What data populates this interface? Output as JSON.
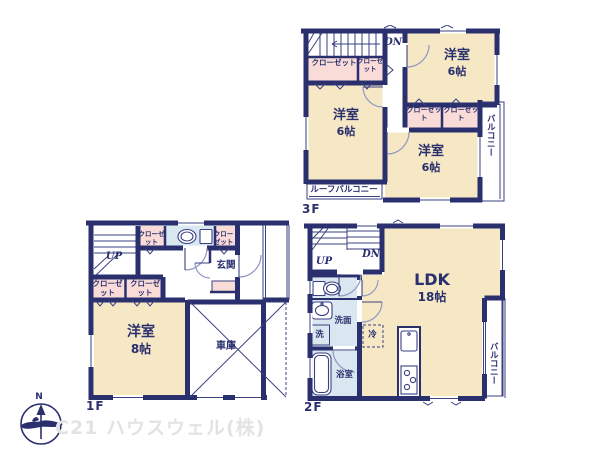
{
  "colors": {
    "wall": "#2A2F6E",
    "line": "#3A4080",
    "arc": "#9298C4",
    "cream": "#F6E8C5",
    "pink": "#F9DCD8",
    "blue": "#D9E7F1",
    "fridge": "#F8E3DF",
    "watermark": "#E3E3E3"
  },
  "f3": {
    "floor_label": "3F",
    "dn": "DN",
    "closet_a": "クローゼット",
    "closet_b": "クローゼット",
    "closet_c": "クローゼット",
    "closet_d": "クローゼット",
    "room_left": {
      "name": "洋室",
      "size": "6帖"
    },
    "room_top_right": {
      "name": "洋室",
      "size": "6帖"
    },
    "room_bottom_right": {
      "name": "洋室",
      "size": "6帖"
    },
    "balcony": "バルコニー",
    "roof_balcony": "ルーフバルコニー"
  },
  "f1": {
    "floor_label": "1F",
    "up": "UP",
    "closet_top": "クローゼット",
    "closet_entry": "クローゼット",
    "closet_a": "クローゼット",
    "closet_b": "クローゼット",
    "entrance": "玄関",
    "room": {
      "name": "洋室",
      "size": "8帖"
    },
    "garage": "車庫"
  },
  "f2": {
    "floor_label": "2F",
    "up": "UP",
    "dn": "DN",
    "washroom": "洗面",
    "laundry": "洗",
    "bathroom": "浴室",
    "fridge": "冷",
    "ldk": {
      "name": "LDK",
      "size": "18帖"
    },
    "balcony": "バルコニー"
  },
  "footer": {
    "company": "C21 ハウスウェル(株)",
    "compass_n": "N"
  }
}
